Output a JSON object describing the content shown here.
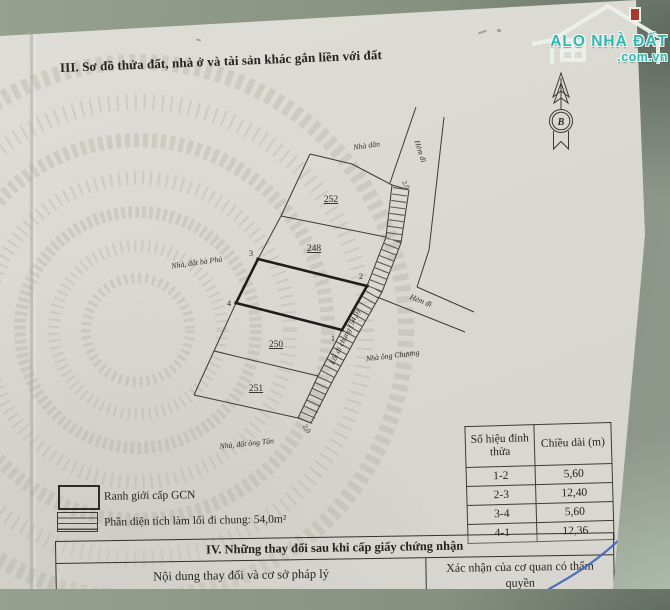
{
  "colors": {
    "fabric": "#8e988a",
    "page": "#dbdad3",
    "ink": "#2e2e29",
    "pen_blue": "#3e63b6",
    "logo_teal": "#2fb7b4"
  },
  "logo": {
    "name": "ALO NHÀ ĐẤT",
    "domain": ".com.vn"
  },
  "section_iii": {
    "title": "III. Sơ đồ thửa đất, nhà ở và tài sản khác gắn liền với đất"
  },
  "compass": {
    "letter": "B"
  },
  "map": {
    "parcel_252": "252",
    "parcel_248": "248",
    "parcel_250": "250",
    "parcel_251": "251",
    "vertex_1": "1",
    "vertex_2": "2",
    "vertex_3": "3",
    "vertex_4": "4",
    "label_nha_dan": "Nhà dân",
    "label_hem_di_top": "Hẻm đi",
    "label_hem_di_right": "Hẻm đi",
    "label_width_top": "2,0",
    "label_width_bottom": "2,0",
    "label_ba_phu": "Nhà, đất bà Phú",
    "label_ong_chuong": "Nhà ông Chương",
    "label_ong_tan": "Nhà, đất ông Tân",
    "label_loi_di": "Lối đi chung (54,0)"
  },
  "legend": {
    "item1": "Ranh giới cấp GCN",
    "item2": "Phần diện tích làm lối đi chung: 54,0m²"
  },
  "dimension_table": {
    "header_col1": "Số hiệu đỉnh thửa",
    "header_col2": "Chiều dài (m)",
    "rows": [
      {
        "pair": "1-2",
        "length": "5,60"
      },
      {
        "pair": "2-3",
        "length": "12,40"
      },
      {
        "pair": "3-4",
        "length": "5,60"
      },
      {
        "pair": "4-1",
        "length": "12,36"
      }
    ]
  },
  "section_iv": {
    "title": "IV. Những thay đổi sau khi cấp giấy chứng nhận",
    "col_left": "Nội dung thay đổi và cơ sở pháp lý",
    "col_right": "Xác nhận của cơ quan có thẩm quyền"
  }
}
